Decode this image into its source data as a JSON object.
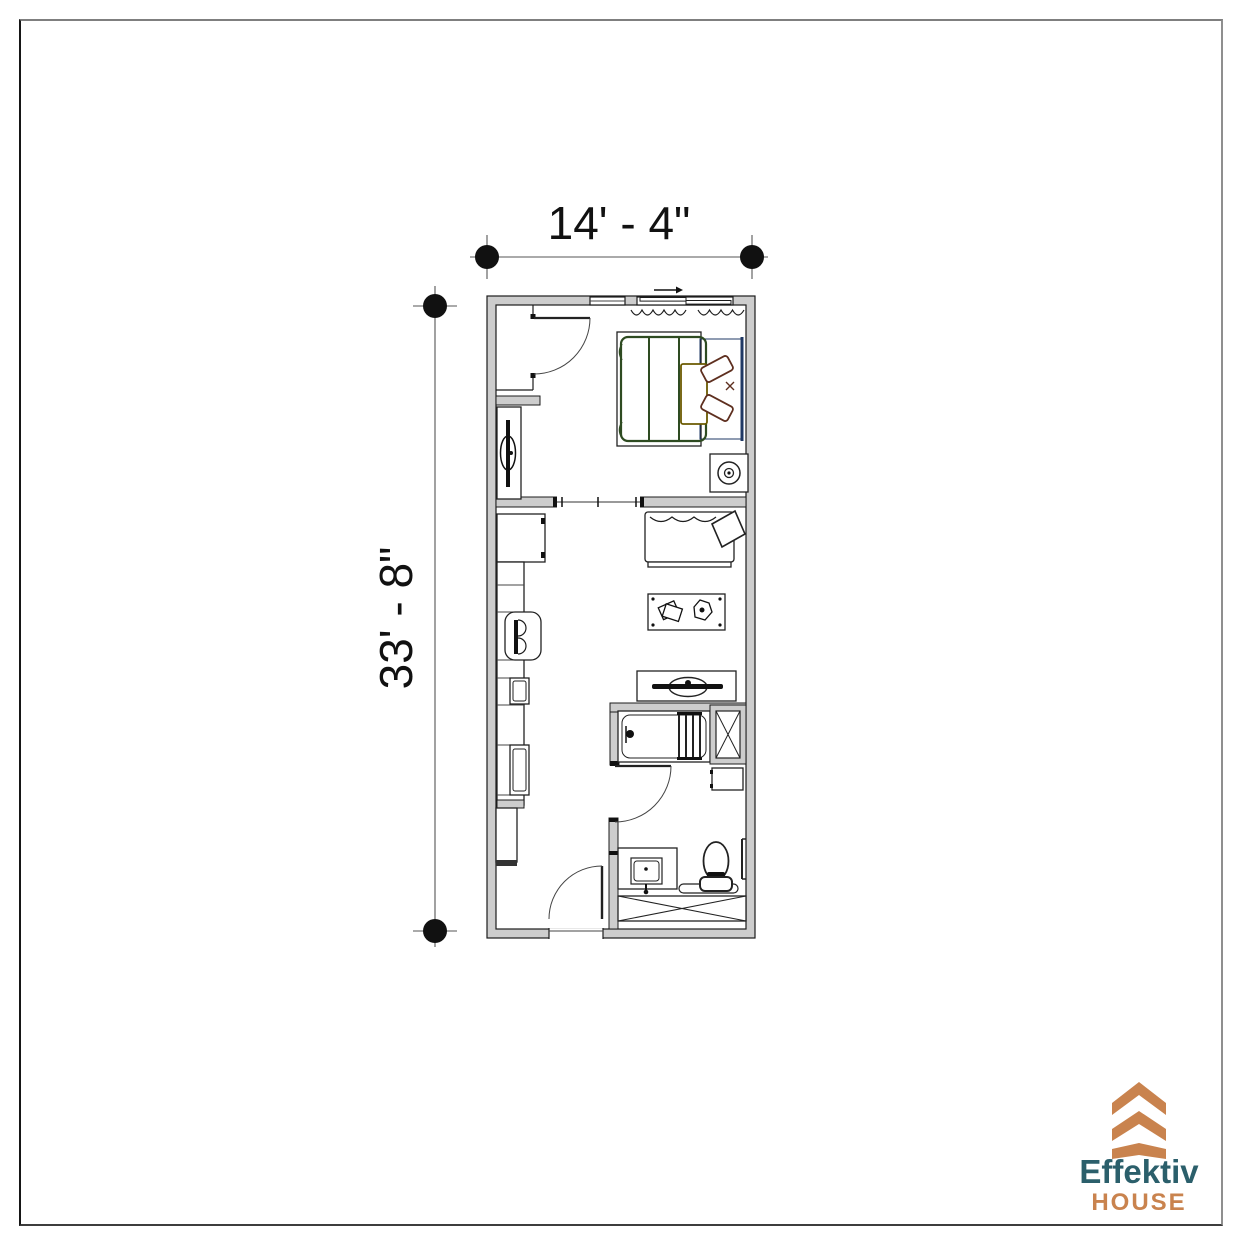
{
  "dimensions": {
    "width_label": "14' - 4\"",
    "height_label": "33' - 8\""
  },
  "logo": {
    "brand": "Effektiv",
    "suffix": "HOUSE"
  },
  "colors": {
    "wall_fill": "#cdcdcd",
    "dim_line": "#555555",
    "bed_blanket_green": "#2e4b21",
    "pillow_maroon": "#5e2f1f",
    "headboard_navy": "#1f3864",
    "folded_throw_olive": "#6b5a00",
    "logo_orange": "#c9834e",
    "logo_teal": "#2b5f6b"
  },
  "plan_items": [
    "exterior-walls",
    "window",
    "sliding-window",
    "slide-arrow",
    "curtains",
    "closet",
    "closet-door",
    "tv-dresser",
    "double-bed",
    "bed-blanket",
    "bed-pillows",
    "headboard",
    "folded-throw",
    "nightstand-with-lamp",
    "interior-opening",
    "refrigerator",
    "kitchen-counter",
    "stove",
    "kitchen-sink",
    "dishwasher",
    "base-cabinet",
    "sofa",
    "throw-blanket",
    "coffee-table",
    "books",
    "decor-bowl",
    "tv-console",
    "television",
    "bathtub",
    "tub-slats",
    "laundry-chase",
    "wall-shelf",
    "bathroom-door",
    "vanity",
    "vanity-sink",
    "toilet",
    "bath-mat",
    "storage-unit",
    "towel-bar",
    "entry-door"
  ]
}
